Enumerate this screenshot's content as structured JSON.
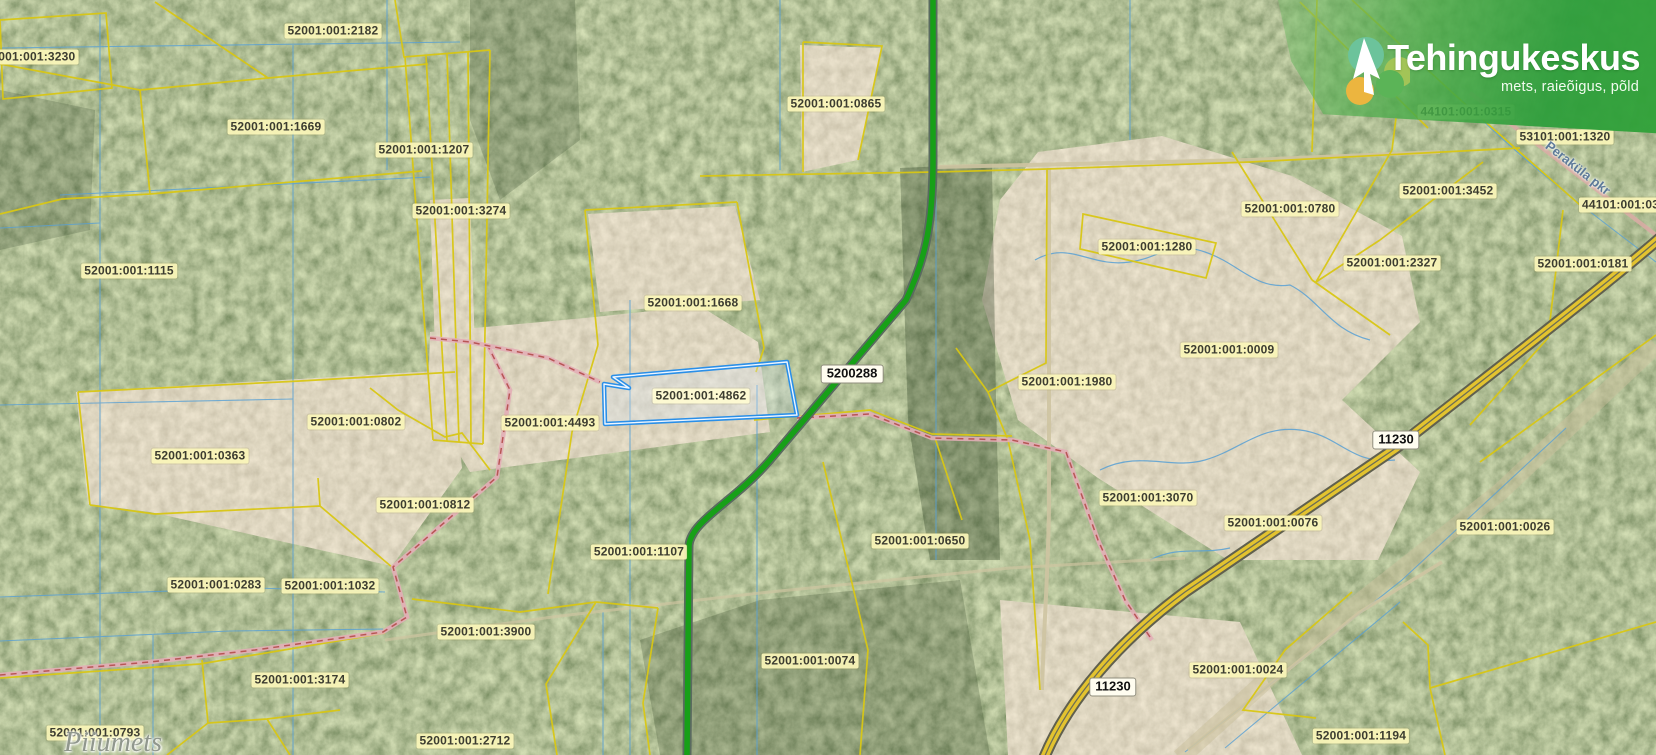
{
  "brand": {
    "title": "Tehingukeskus",
    "subtitle": "mets, raieõigus, põld"
  },
  "map": {
    "selected_parcel": "52001:001:4862",
    "parcel_labels": [
      {
        "text": "52001:001:3230",
        "x": 30,
        "y": 57
      },
      {
        "text": "52001:001:2182",
        "x": 333,
        "y": 31
      },
      {
        "text": "52001:001:1669",
        "x": 276,
        "y": 127
      },
      {
        "text": "52001:001:1207",
        "x": 424,
        "y": 150
      },
      {
        "text": "52001:001:3274",
        "x": 461,
        "y": 211
      },
      {
        "text": "52001:001:1115",
        "x": 129,
        "y": 271
      },
      {
        "text": "52001:001:0865",
        "x": 836,
        "y": 104
      },
      {
        "text": "52001:001:1668",
        "x": 693,
        "y": 303
      },
      {
        "text": "52001:001:4862",
        "x": 701,
        "y": 396,
        "selected": true
      },
      {
        "text": "52001:001:4493",
        "x": 550,
        "y": 423
      },
      {
        "text": "52001:001:0802",
        "x": 356,
        "y": 422
      },
      {
        "text": "52001:001:0363",
        "x": 200,
        "y": 456
      },
      {
        "text": "52001:001:0812",
        "x": 425,
        "y": 505
      },
      {
        "text": "52001:001:1107",
        "x": 639,
        "y": 552
      },
      {
        "text": "52001:001:0650",
        "x": 920,
        "y": 541
      },
      {
        "text": "52001:001:0283",
        "x": 216,
        "y": 585
      },
      {
        "text": "52001:001:1032",
        "x": 330,
        "y": 586
      },
      {
        "text": "52001:001:3900",
        "x": 486,
        "y": 632
      },
      {
        "text": "52001:001:3174",
        "x": 300,
        "y": 680
      },
      {
        "text": "52001:001:0074",
        "x": 810,
        "y": 661
      },
      {
        "text": "52001:001:2712",
        "x": 465,
        "y": 741
      },
      {
        "text": "52001:001:0793",
        "x": 95,
        "y": 733
      },
      {
        "text": "52001:001:1980",
        "x": 1067,
        "y": 382
      },
      {
        "text": "52001:001:1280",
        "x": 1147,
        "y": 247
      },
      {
        "text": "52001:001:0780",
        "x": 1290,
        "y": 209
      },
      {
        "text": "52001:001:0009",
        "x": 1229,
        "y": 350
      },
      {
        "text": "52001:001:3070",
        "x": 1148,
        "y": 498
      },
      {
        "text": "52001:001:0076",
        "x": 1273,
        "y": 523
      },
      {
        "text": "52001:001:3452",
        "x": 1448,
        "y": 191
      },
      {
        "text": "52001:001:2327",
        "x": 1392,
        "y": 263
      },
      {
        "text": "52001:001:0181",
        "x": 1583,
        "y": 264
      },
      {
        "text": "52001:001:0026",
        "x": 1505,
        "y": 527
      },
      {
        "text": "52001:001:0024",
        "x": 1238,
        "y": 670
      },
      {
        "text": "52001:001:1194",
        "x": 1361,
        "y": 736
      },
      {
        "text": "44101:001:0315",
        "x": 1466,
        "y": 112
      },
      {
        "text": "53101:001:1320",
        "x": 1565,
        "y": 137
      },
      {
        "text": "44101:001:031",
        "x": 1624,
        "y": 205
      }
    ],
    "road_labels": [
      {
        "text": "5200288",
        "x": 852,
        "y": 374
      },
      {
        "text": "11230",
        "x": 1396,
        "y": 440
      },
      {
        "text": "11230",
        "x": 1113,
        "y": 687
      }
    ],
    "place_labels": [
      {
        "text": "Piiumets",
        "x": 113,
        "y": 743
      }
    ],
    "water_labels": [
      {
        "text": "Peraküla pkr",
        "x": 1578,
        "y": 168,
        "angle": 38
      }
    ]
  },
  "colors": {
    "boundary_yellow": "#d9c713",
    "cadastral_blue": "#58a0d4",
    "selected_blue": "#2a8fe8",
    "road_green": "#17a017",
    "road_yellow": "#e3c32f",
    "brand_green": "#2f9e3c",
    "label_bg": "#f8f3b6"
  }
}
